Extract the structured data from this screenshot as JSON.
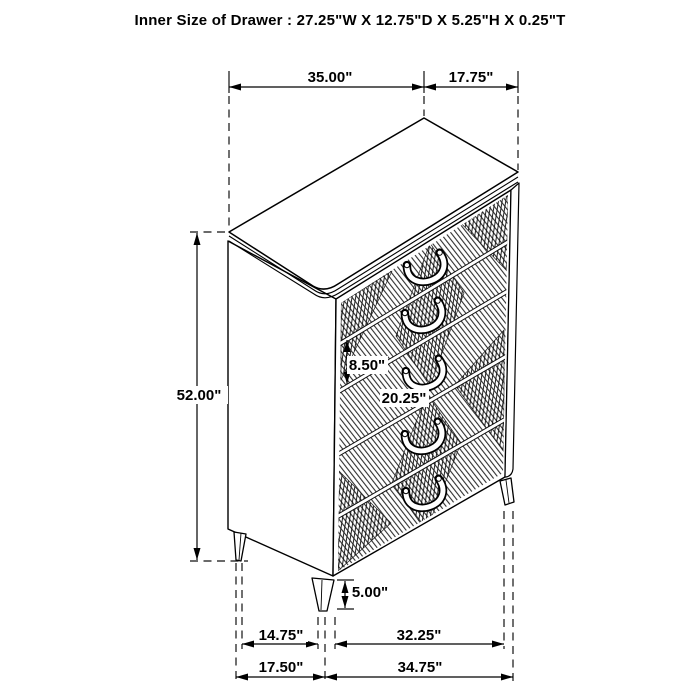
{
  "title": "Inner Size of Drawer : 27.25\"W X 12.75\"D X 5.25\"H X 0.25\"T",
  "diagram": {
    "type": "furniture-dimension-diagram",
    "item": "5-drawer chest with geometric hatched drawer fronts and splayed legs",
    "units": "inches",
    "labels": {
      "top_width": "35.00\"",
      "top_depth": "17.75\"",
      "overall_height": "52.00\"",
      "drawer_front_height": "8.50\"",
      "drawer_width": "20.25\"",
      "leg_height": "5.00\"",
      "leg_span_depth": "14.75\"",
      "leg_span_width": "32.25\"",
      "base_depth": "17.50\"",
      "base_width": "34.75\""
    }
  }
}
